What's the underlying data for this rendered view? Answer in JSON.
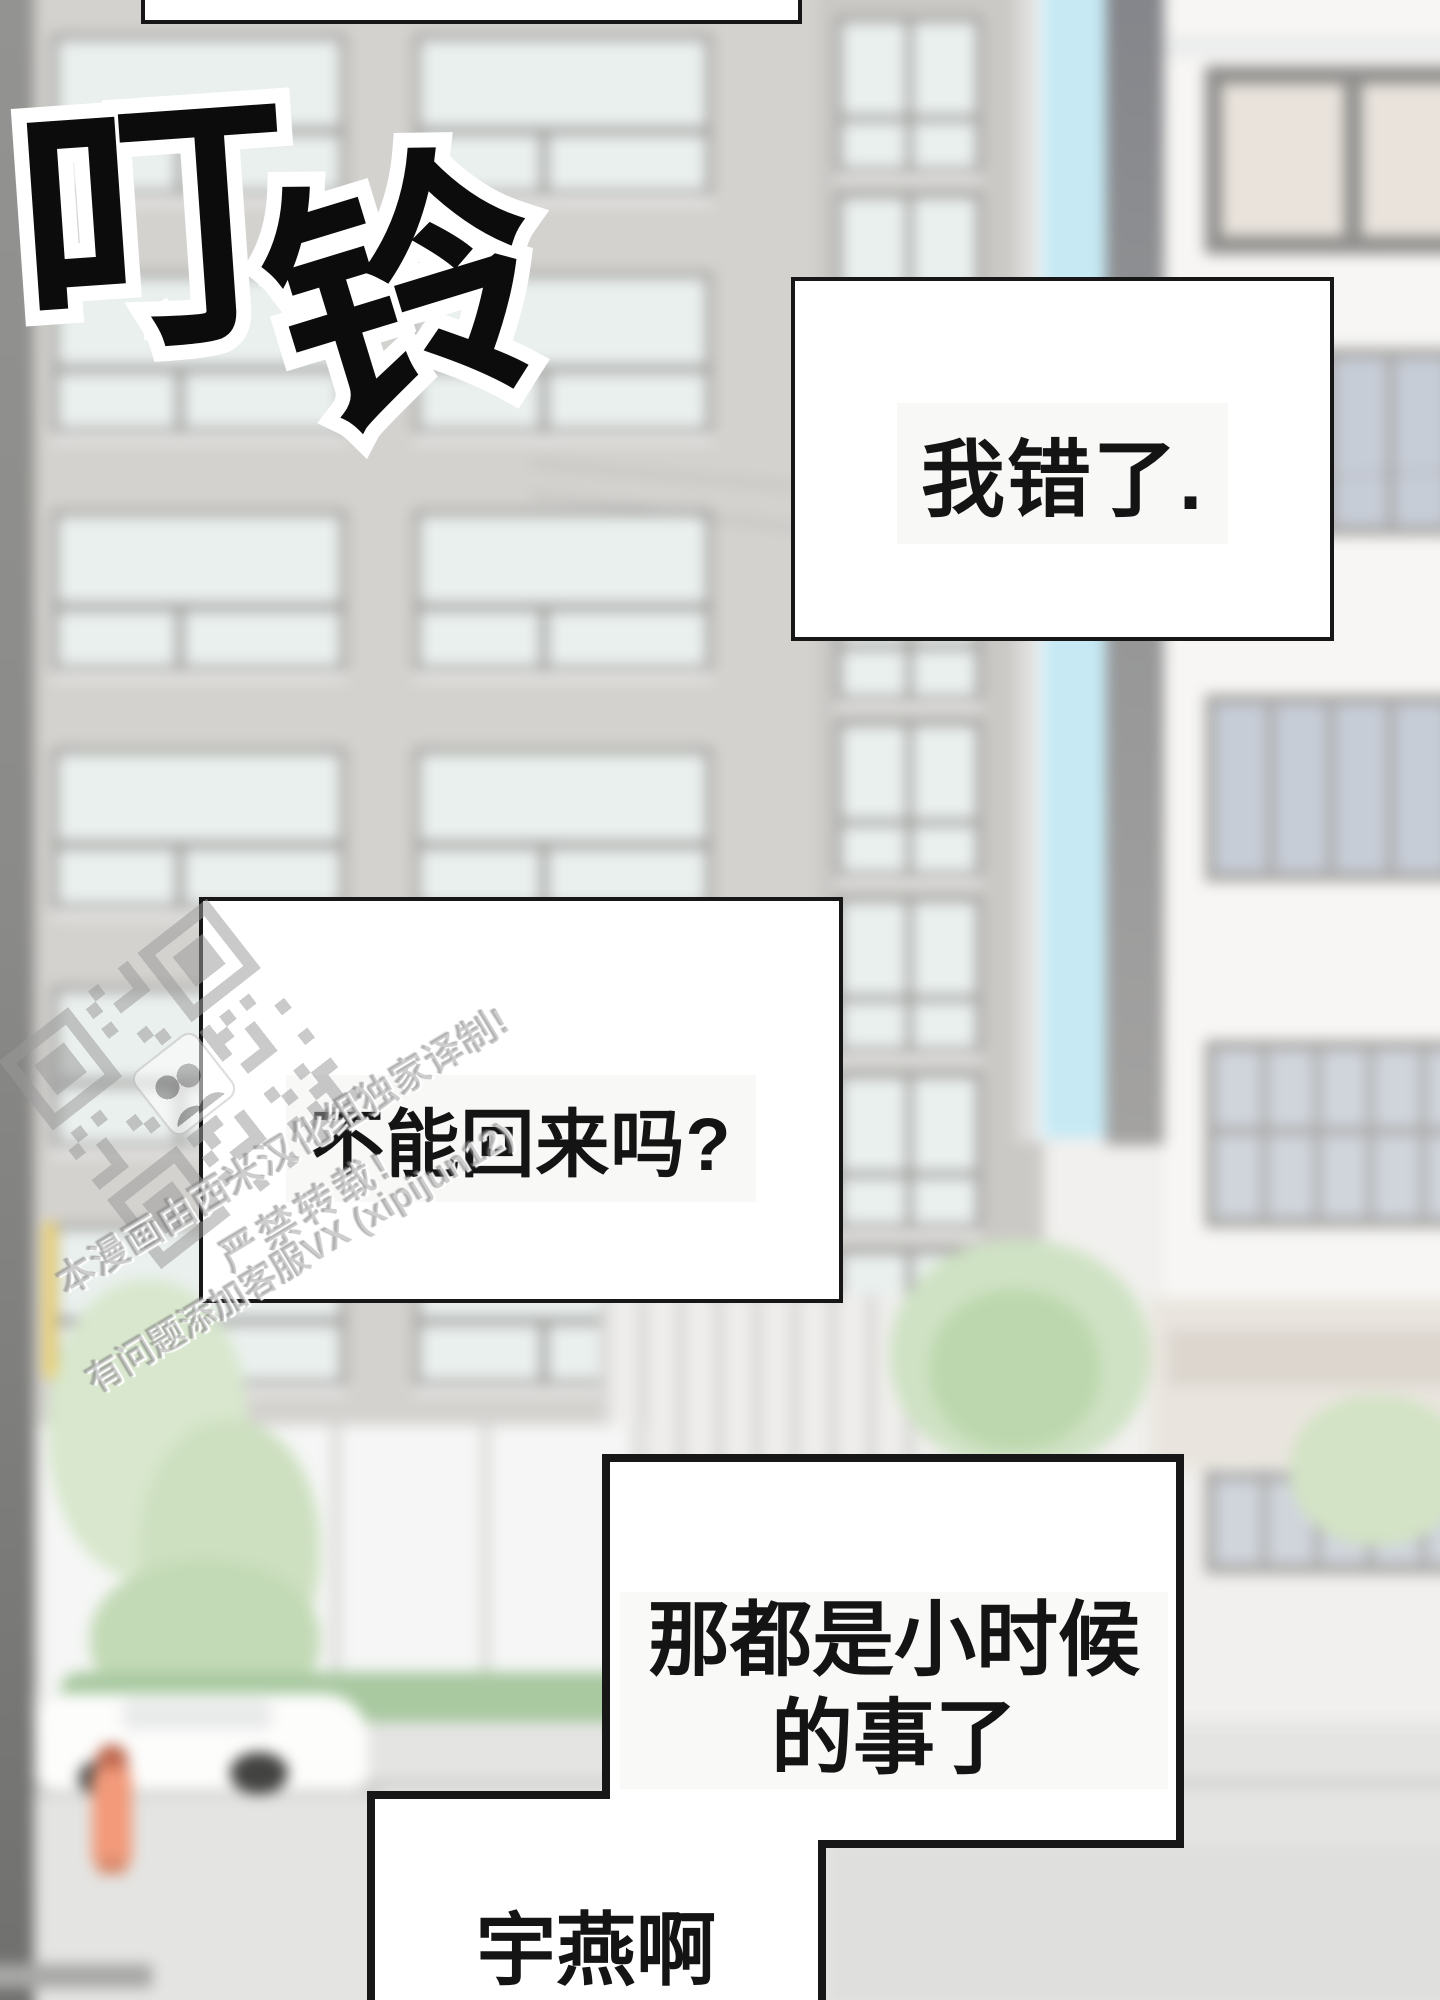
{
  "sfx": {
    "text": "叮铃",
    "char1": "叮",
    "char2": "铃"
  },
  "speech": {
    "box1": "我错了.",
    "box2": "不能回来吗?",
    "box3_line1": "那都是小时候",
    "box3_line2": "的事了",
    "box4": "宇燕啊"
  },
  "watermark": {
    "line1": "本漫画由西米汉化组独家译制!",
    "line2": "严禁转载!",
    "line3": "有问题添加客服VX (xipijun12)",
    "qr": "qr-code-watermark"
  },
  "colors": {
    "ink": "#171717",
    "paper": "#ffffff",
    "wall_gray": "#d4d2cf",
    "window_pane": "#eaf0ee",
    "glass_cyan": "#c6e9f4",
    "window_blue": "#c7cdd7",
    "foliage": "#d8e7cd",
    "hedge": "#a9c9a1",
    "street": "#e4e4e2",
    "hydrant": "#f29a7a",
    "pole_yellow": "#eed26a",
    "watermark_gray": "#9a9a9a"
  }
}
